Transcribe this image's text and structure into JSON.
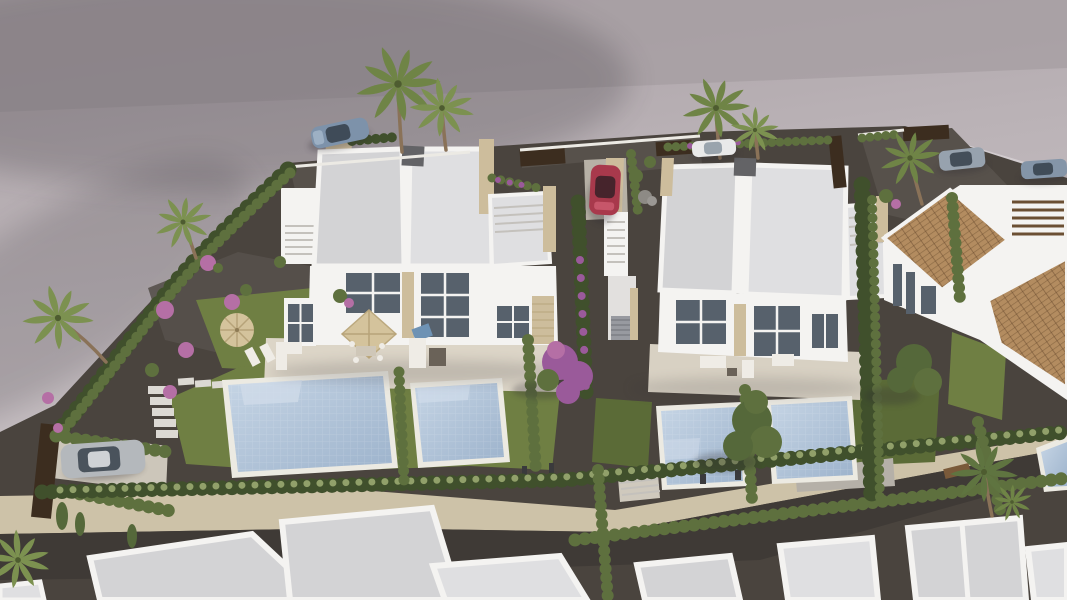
{
  "scene": {
    "type": "aerial-architectural-render",
    "description": "Aerial 3D architectural render of a modern residential development: two white duplex villas with flat roofs, beige travertine accents, private gardens with swimming pools, cypress hedges and palm trees; a curved grey road with parked cars at the top, a tile-roofed house on the right, and a row of white flat-roofed houses along the bottom.",
    "counts": {
      "duplex_villas": 2,
      "visible_pools": 5,
      "cars": 6,
      "palm_trees": 7
    },
    "objects": [
      "road",
      "parked-cars",
      "duplex-villa-left",
      "duplex-villa-right",
      "terracotta-roof-house",
      "bottom-house-row",
      "swimming-pools",
      "gardens",
      "cypress-hedges",
      "palm-trees",
      "parasols",
      "driveway"
    ]
  },
  "palette": {
    "pavement_top": "#a59da1",
    "pavement": "#bfb7bb",
    "pavement_light": "#d0c9cc",
    "plot_gravel": "#4a443e",
    "gravel_light": "#57514b",
    "path_beige": "#cdc2a8",
    "stone": "#cdbd9c",
    "stone_dark": "#b3a17c",
    "grass": "#6f7f43",
    "grass_dark": "#5b6b37",
    "hedge_dark": "#40502c",
    "hedge_mid": "#5e703e",
    "hedge_light": "#91a06a",
    "pool_water": "#b5c9de",
    "pool_deep": "#9db3cc",
    "pool_step": "#cfdbe9",
    "pool_deck": "#eceae2",
    "roof": "#d3d3d5",
    "roof_light": "#dfdfe1",
    "white_wall": "#f4f3f1",
    "wall_shade": "#e2e0de",
    "glass": "#57616c",
    "chimney": "#636366",
    "terracotta": "#b38c60",
    "terracotta_dark": "#8e6c46",
    "wood_fence": "#3c2d1f",
    "trunk": "#8a7258",
    "palm_green": "#6f8446",
    "tree_green": "#55683a",
    "flower_pink": "#b56fa5",
    "flower_purple": "#9a5a9a",
    "car_blue": "#7d92aa",
    "car_red": "#a8394c",
    "car_white": "#e9e9e9",
    "car_silver": "#b4b8bc",
    "car_gray": "#97a2ae",
    "parasol": "#d4c39c",
    "furniture": "#efece6",
    "shadow": "#2e2a33"
  }
}
